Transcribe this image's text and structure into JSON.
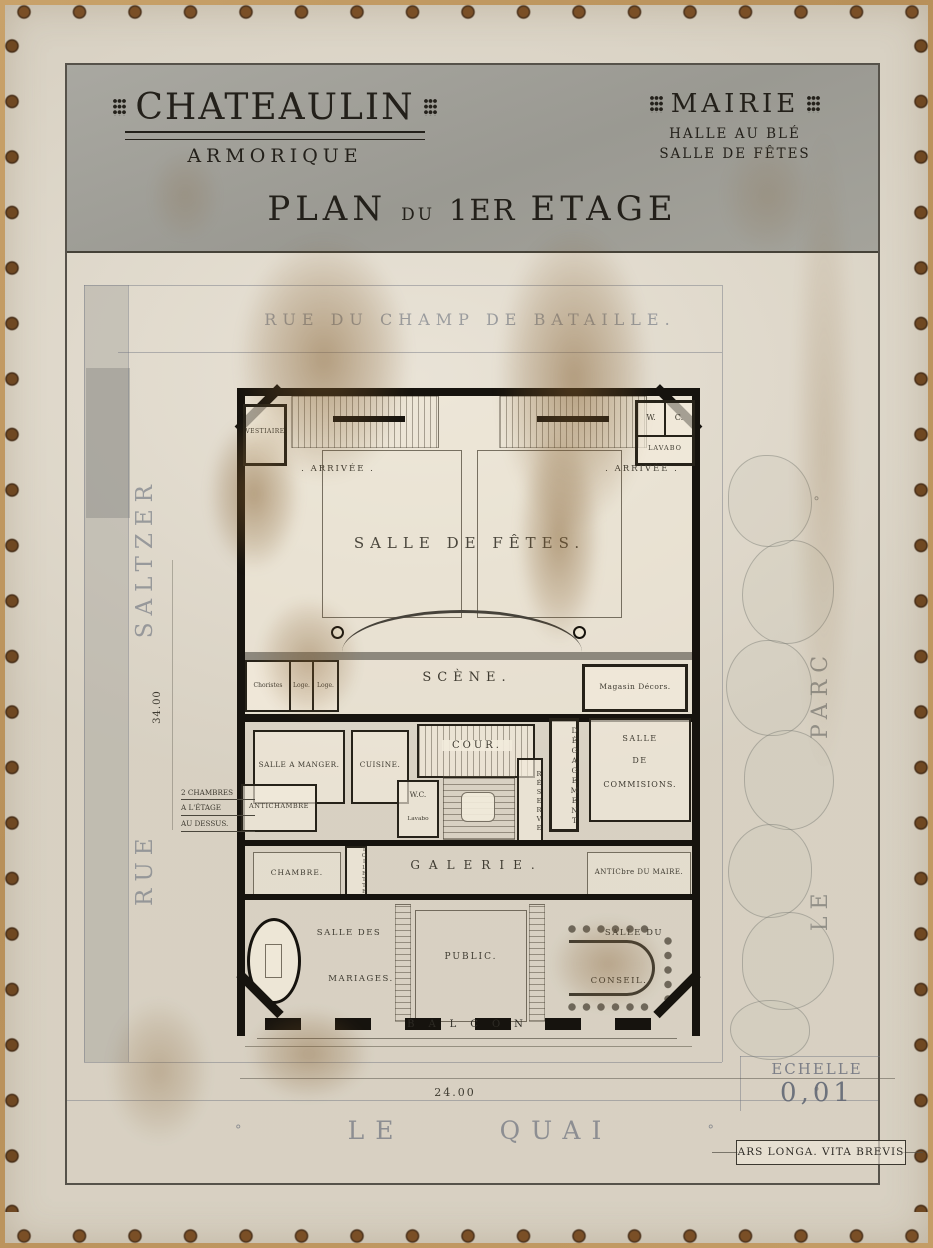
{
  "header": {
    "city": "CHATEAULIN",
    "region": "ARMORIQUE",
    "building": "MAIRIE",
    "building_sub1": "HALLE AU BLÉ",
    "building_sub2": "SALLE DE FÊTES",
    "title_plan": "PLAN",
    "title_du": "DU",
    "title_num": "1ER",
    "title_etage": "ETAGE"
  },
  "streets": {
    "top": "RUE DU CHAMP DE BATAILLE.",
    "left_word1": "RUE",
    "left_word2": "SALTZER",
    "right_word1": "LE",
    "right_word2": "PARC",
    "bottom_word1": "LE",
    "bottom_word2": "QUAI",
    "ornament": "°"
  },
  "rooms": {
    "vestiaire": "VESTIAIRE",
    "wc_top_w": "W.",
    "wc_top_c": "C.",
    "lavabo_top": "LAVABO",
    "arrivee_left": ". ARRIVÉE .",
    "arrivee_right": ". ARRIVÉE .",
    "salle_de_fetes": "SALLE DE FÊTES.",
    "scene": "SCÈNE.",
    "choristes": "Choristes",
    "loge1": "Loge.",
    "loge2": "Loge.",
    "magasin_decors": "Magasin Décors.",
    "salle_a_manger": "SALLE A MANGER.",
    "cuisine": "CUISINE.",
    "cour": "COUR.",
    "degagement": "DÉGAGEMENT",
    "reserve": "RÉSERVE",
    "commissions_1": "SALLE",
    "commissions_2": "DE",
    "commissions_3": "COMMISIONS.",
    "antichambre": "ANTICHAMBRE",
    "wc_mid": "W.C.",
    "lavabo_mid": "Lavabo",
    "chambre": "CHAMBRE.",
    "toilette": "TOILETTE.",
    "galerie": "GALERIE.",
    "antichambre_maire": "ANTICbre DU MAIRE.",
    "mariages_1": "SALLE DES",
    "mariages_2": "MARIAGES.",
    "public": "PUBLIC.",
    "conseil_1": "SALLE DU",
    "conseil_2": "CONSEIL.",
    "balcon": "BALCON"
  },
  "annotations": {
    "note_line1": "2 CHAMBRES",
    "note_line2": "A L'ÉTAGE",
    "note_line3": "AU DESSUS.",
    "dim_width": "24.00",
    "dim_height": "34.00",
    "scale_label": "ECHELLE",
    "scale_value": "0,01",
    "motto": "ARS LONGA. VITA BREVIS"
  }
}
